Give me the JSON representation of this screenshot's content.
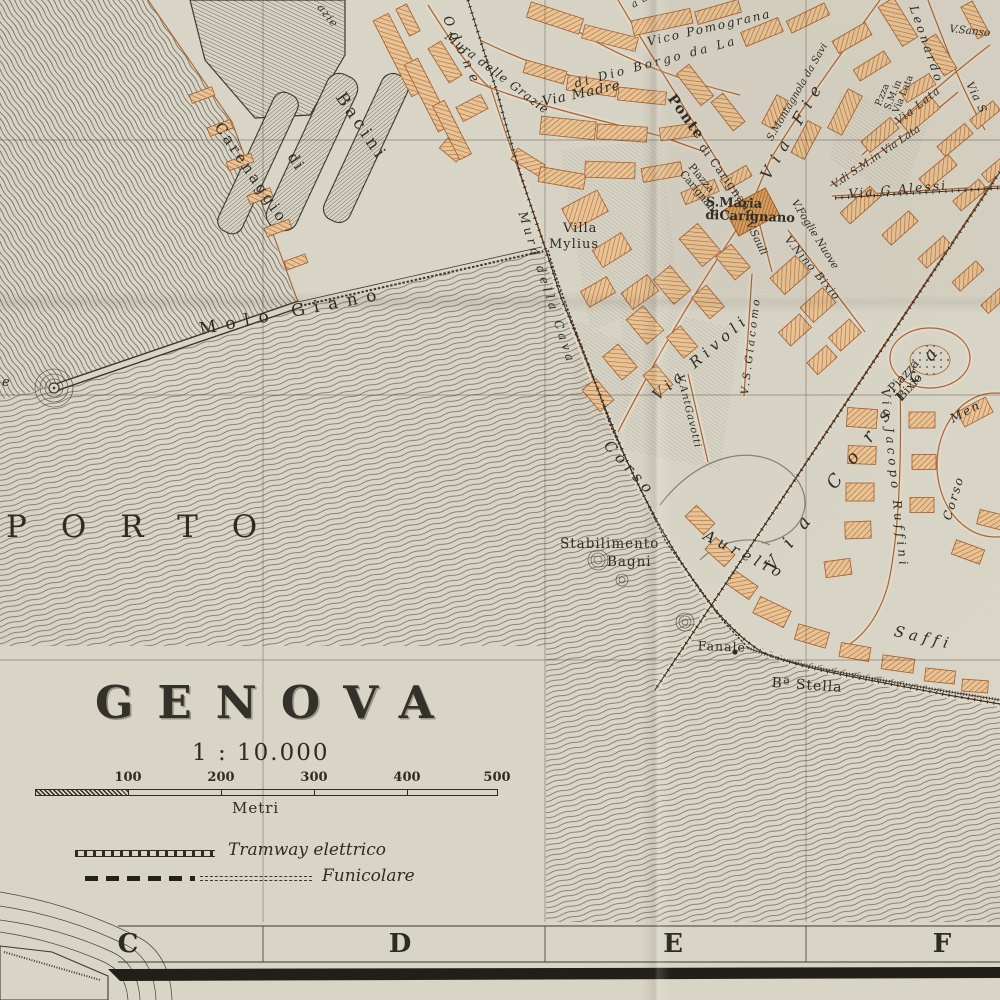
{
  "map": {
    "title": "GENOVA",
    "scale_text": "1 : 10.000",
    "scale_unit": "Metri",
    "scale_ticks": [
      {
        "label": "",
        "x": 35
      },
      {
        "label": "100",
        "x": 128
      },
      {
        "label": "200",
        "x": 221
      },
      {
        "label": "300",
        "x": 314
      },
      {
        "label": "400",
        "x": 407
      },
      {
        "label": "500",
        "x": 497
      }
    ],
    "legend": {
      "items": [
        {
          "name": "tramway",
          "label": "Tramway elettrico"
        },
        {
          "name": "funicolare",
          "label": "Funicolare"
        }
      ]
    },
    "grid_letters": [
      {
        "ch": "C",
        "x": 128
      },
      {
        "ch": "D",
        "x": 400
      },
      {
        "ch": "E",
        "x": 673
      },
      {
        "ch": "F",
        "x": 942
      }
    ],
    "labels": [
      {
        "name": "label-porto",
        "text": "PORTO",
        "x": 6,
        "y": 512,
        "rot": 0,
        "fs": 31,
        "ls": 34,
        "cls": ""
      },
      {
        "name": "label-molo-giano",
        "text": "Molo Giano",
        "x": 198,
        "y": 322,
        "rot": -11,
        "fs": 17,
        "ls": 9,
        "cls": ""
      },
      {
        "name": "label-bacini",
        "text": "Bacini",
        "x": 346,
        "y": 90,
        "rot": 56,
        "fs": 17,
        "ls": 4,
        "cls": ""
      },
      {
        "name": "label-bacini-di",
        "text": "di",
        "x": 297,
        "y": 150,
        "rot": 56,
        "fs": 15,
        "ls": 2,
        "cls": ""
      },
      {
        "name": "label-carenaggio",
        "text": "Carenaggio",
        "x": 224,
        "y": 120,
        "rot": 56,
        "fs": 15,
        "ls": 3,
        "cls": ""
      },
      {
        "name": "label-odone",
        "text": "Odone",
        "x": 452,
        "y": 14,
        "rot": 66,
        "fs": 13,
        "ls": 7,
        "cls": "it"
      },
      {
        "name": "label-mura-delle-grazie",
        "text": "Mura delle Grazie",
        "x": 450,
        "y": 30,
        "rot": 37,
        "fs": 12,
        "ls": 1,
        "cls": "it"
      },
      {
        "name": "label-grazie-fragment",
        "text": "azie",
        "x": 324,
        "y": 2,
        "rot": 52,
        "fs": 11,
        "ls": 1,
        "cls": "it"
      },
      {
        "name": "label-via-madre",
        "text": "Via Madre",
        "x": 541,
        "y": 96,
        "rot": -12,
        "fs": 13.5,
        "ls": 1,
        "cls": "it"
      },
      {
        "name": "label-di-dio-borgo",
        "text": "di Dio Borgo da La",
        "x": 573,
        "y": 78,
        "rot": -15,
        "fs": 12,
        "ls": 3,
        "cls": "it"
      },
      {
        "name": "label-vico-pomogranato",
        "text": "Vico Pomograna",
        "x": 646,
        "y": 36,
        "rot": -13,
        "fs": 12,
        "ls": 2,
        "cls": "it"
      },
      {
        "name": "label-fragment-a-al",
        "text": "a al",
        "x": 630,
        "y": 2,
        "rot": -30,
        "fs": 10,
        "ls": 1,
        "cls": "it"
      },
      {
        "name": "label-ponte",
        "text": "Ponte",
        "x": 676,
        "y": 92,
        "rot": 54,
        "fs": 14.5,
        "ls": 1,
        "cls": "b"
      },
      {
        "name": "label-ponte-di-carignano",
        "text": "di Carignano",
        "x": 706,
        "y": 142,
        "rot": 54,
        "fs": 11.5,
        "ls": 1,
        "cls": ""
      },
      {
        "name": "label-piazza-carignano",
        "text": "Piazza\nCarignano",
        "x": 694,
        "y": 162,
        "rot": 50,
        "fs": 10.5,
        "ls": 0,
        "cls": ""
      },
      {
        "name": "label-smaria-dicarignano",
        "text": "S.Maria\ndiCarignano",
        "x": 706,
        "y": 196,
        "rot": 2,
        "fs": 13,
        "ls": 0,
        "cls": "b"
      },
      {
        "name": "label-montagnola",
        "text": "S.Montagnola da Savi",
        "x": 766,
        "y": 138,
        "rot": -60,
        "fs": 10,
        "ls": 0,
        "cls": "it"
      },
      {
        "name": "label-via-fieschi",
        "text": "Via Fie",
        "x": 758,
        "y": 174,
        "rot": -60,
        "fs": 16,
        "ls": 8,
        "cls": "it"
      },
      {
        "name": "label-leonardo",
        "text": "Leonardo",
        "x": 919,
        "y": 4,
        "rot": 71,
        "fs": 12,
        "ls": 3,
        "cls": "it"
      },
      {
        "name": "label-v-sansone",
        "text": "V.Sanso",
        "x": 950,
        "y": 24,
        "rot": 6,
        "fs": 10.5,
        "ls": 0,
        "cls": "it"
      },
      {
        "name": "label-pzza-via-lata",
        "text": "P.zza\nS.M.in\nVia Lata",
        "x": 874,
        "y": 104,
        "rot": -68,
        "fs": 9.5,
        "ls": 0,
        "cls": ""
      },
      {
        "name": "label-v-di-sm-via-lata",
        "text": "V.di S.M.in Via Lata",
        "x": 830,
        "y": 182,
        "rot": -34,
        "fs": 10.5,
        "ls": 0,
        "cls": "it"
      },
      {
        "name": "label-via-lata",
        "text": "Via Lata",
        "x": 893,
        "y": 118,
        "rot": -38,
        "fs": 11,
        "ls": 1,
        "cls": "it"
      },
      {
        "name": "label-via-s-fragment",
        "text": "Via S",
        "x": 974,
        "y": 80,
        "rot": 64,
        "fs": 11,
        "ls": 1,
        "cls": "it"
      },
      {
        "name": "label-via-g-alessi",
        "text": "Via G.Alessi",
        "x": 848,
        "y": 188,
        "rot": -5,
        "fs": 12.5,
        "ls": 2,
        "cls": "it"
      },
      {
        "name": "label-v-foglie-nuove",
        "text": "V.Foglie Nuove",
        "x": 798,
        "y": 198,
        "rot": 58,
        "fs": 10.5,
        "ls": 0,
        "cls": "it"
      },
      {
        "name": "label-v-sauli",
        "text": "V.Sauli",
        "x": 753,
        "y": 220,
        "rot": 64,
        "fs": 10.5,
        "ls": 0,
        "cls": "it"
      },
      {
        "name": "label-v-nino-bixio",
        "text": "V.Nino Bixio",
        "x": 791,
        "y": 234,
        "rot": 50,
        "fs": 11,
        "ls": 1,
        "cls": "it"
      },
      {
        "name": "label-v-s-giacomo",
        "text": "V.S.Giacomo",
        "x": 740,
        "y": 394,
        "rot": -83,
        "fs": 10.5,
        "ls": 3,
        "cls": "it"
      },
      {
        "name": "label-via-rivoli",
        "text": "Via Rivoli",
        "x": 650,
        "y": 392,
        "rot": -41,
        "fs": 15,
        "ls": 5,
        "cls": "it"
      },
      {
        "name": "label-v-ant-gavotti",
        "text": "V.AntGavotti",
        "x": 684,
        "y": 374,
        "rot": 76,
        "fs": 10,
        "ls": 1,
        "cls": "it"
      },
      {
        "name": "label-via-corsica",
        "text": "Via Corsica",
        "x": 762,
        "y": 564,
        "rot": -53,
        "fs": 18,
        "ls": 17,
        "cls": "it"
      },
      {
        "name": "label-piazza-bixio",
        "text": "Piazza\nBixio",
        "x": 886,
        "y": 386,
        "rot": -48,
        "fs": 12,
        "ls": 0,
        "cls": ""
      },
      {
        "name": "label-via-jacopo-ruffini",
        "text": "Via Jacopo Ruffini",
        "x": 891,
        "y": 388,
        "rot": 84,
        "fs": 12,
        "ls": 4,
        "cls": "it"
      },
      {
        "name": "label-corso-mentana-1",
        "text": "Corso",
        "x": 941,
        "y": 518,
        "rot": -73,
        "fs": 12,
        "ls": 2,
        "cls": "it"
      },
      {
        "name": "label-corso-mentana-2",
        "text": "Men",
        "x": 948,
        "y": 414,
        "rot": -28,
        "fs": 12,
        "ls": 2,
        "cls": "it"
      },
      {
        "name": "label-stabilimento",
        "text": "Stabilimento",
        "x": 560,
        "y": 538,
        "rot": 0,
        "fs": 13.5,
        "ls": 1,
        "cls": ""
      },
      {
        "name": "label-bagni",
        "text": "Bagni",
        "x": 607,
        "y": 556,
        "rot": 0,
        "fs": 13.5,
        "ls": 1,
        "cls": ""
      },
      {
        "name": "label-fanale",
        "text": "Fanale",
        "x": 698,
        "y": 640,
        "rot": 2,
        "fs": 12.5,
        "ls": 1,
        "cls": ""
      },
      {
        "name": "label-ba-stella",
        "text": "Bª Stella",
        "x": 772,
        "y": 676,
        "rot": 4,
        "fs": 14,
        "ls": 1,
        "cls": ""
      },
      {
        "name": "label-villa",
        "text": "Villa",
        "x": 563,
        "y": 222,
        "rot": 0,
        "fs": 13,
        "ls": 1,
        "cls": ""
      },
      {
        "name": "label-mylius",
        "text": "Mylius",
        "x": 549,
        "y": 238,
        "rot": 0,
        "fs": 13,
        "ls": 1,
        "cls": ""
      },
      {
        "name": "label-mura-della-cava",
        "text": "Mura della Cava",
        "x": 528,
        "y": 210,
        "rot": 72,
        "fs": 12,
        "ls": 4,
        "cls": "it"
      },
      {
        "name": "label-corso-aurelio-1",
        "text": "Corso",
        "x": 612,
        "y": 438,
        "rot": 48,
        "fs": 15,
        "ls": 5,
        "cls": "it"
      },
      {
        "name": "label-corso-aurelio-2",
        "text": "Aurelio",
        "x": 708,
        "y": 528,
        "rot": 27,
        "fs": 15,
        "ls": 5,
        "cls": "it"
      },
      {
        "name": "label-corso-aurelio-3",
        "text": "Saffi",
        "x": 896,
        "y": 624,
        "rot": 13,
        "fs": 15,
        "ls": 5,
        "cls": "it"
      },
      {
        "name": "label-edge-fragment",
        "text": "e",
        "x": 2,
        "y": 376,
        "rot": 0,
        "fs": 13,
        "ls": 0,
        "cls": "it"
      }
    ]
  }
}
